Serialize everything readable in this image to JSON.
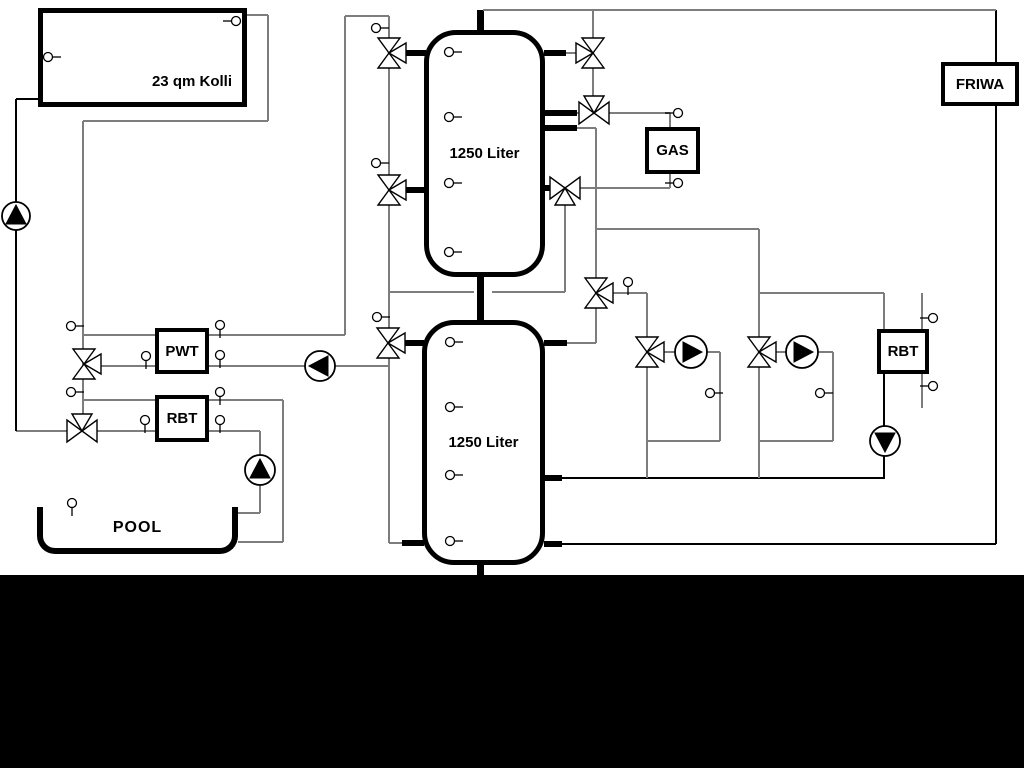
{
  "labels": {
    "collector": "23 qm Kolli",
    "tank_top": "1250 Liter",
    "tank_bottom": "1250 Liter",
    "pwt": "PWT",
    "rbt_left": "RBT",
    "rbt_right": "RBT",
    "gas": "GAS",
    "friwa": "FRIWA",
    "pool": "POOL"
  },
  "colors": {
    "line_gray": "#7d7d7d",
    "line_black": "#000000"
  },
  "diagram": {
    "band": {
      "top": 575,
      "height": 193
    },
    "lines": [
      [
        16,
        99,
        16,
        431,
        "b"
      ],
      [
        16,
        99,
        38,
        99,
        "b"
      ],
      [
        16,
        431,
        155,
        431,
        "g"
      ],
      [
        247,
        15,
        268,
        15,
        "g"
      ],
      [
        268,
        15,
        268,
        121,
        "g"
      ],
      [
        83,
        121,
        268,
        121,
        "g"
      ],
      [
        83,
        121,
        83,
        431,
        "g"
      ],
      [
        83,
        335,
        155,
        335,
        "g"
      ],
      [
        83,
        366,
        155,
        366,
        "g"
      ],
      [
        209,
        335,
        345,
        335,
        "g"
      ],
      [
        345,
        16,
        345,
        335,
        "g"
      ],
      [
        209,
        366,
        388,
        366,
        "g"
      ],
      [
        345,
        16,
        389,
        16,
        "g"
      ],
      [
        389,
        16,
        389,
        543,
        "g"
      ],
      [
        389,
        543,
        402,
        543,
        "g"
      ],
      [
        483,
        10,
        996,
        10,
        "g"
      ],
      [
        996,
        10,
        996,
        62,
        "b"
      ],
      [
        996,
        106,
        996,
        544,
        "b"
      ],
      [
        593,
        10,
        593,
        103,
        "g"
      ],
      [
        566,
        53,
        578,
        53,
        "g"
      ],
      [
        577,
        113,
        670,
        113,
        "g"
      ],
      [
        670,
        113,
        670,
        127,
        "g"
      ],
      [
        577,
        128,
        596,
        128,
        "g"
      ],
      [
        596,
        128,
        596,
        343,
        "g"
      ],
      [
        556,
        188,
        670,
        188,
        "g"
      ],
      [
        670,
        174,
        670,
        188,
        "g"
      ],
      [
        565,
        196,
        565,
        292,
        "g"
      ],
      [
        388,
        292,
        474,
        292,
        "g"
      ],
      [
        492,
        292,
        565,
        292,
        "g"
      ],
      [
        567,
        343,
        596,
        343,
        "g"
      ],
      [
        596,
        229,
        759,
        229,
        "g"
      ],
      [
        759,
        229,
        759,
        478,
        "g"
      ],
      [
        759,
        293,
        884,
        293,
        "g"
      ],
      [
        884,
        293,
        884,
        330,
        "g"
      ],
      [
        884,
        374,
        884,
        478,
        "b"
      ],
      [
        922,
        293,
        922,
        329,
        "g"
      ],
      [
        922,
        374,
        922,
        408,
        "g"
      ],
      [
        596,
        293,
        647,
        293,
        "g"
      ],
      [
        647,
        293,
        647,
        478,
        "g"
      ],
      [
        647,
        352,
        676,
        352,
        "g"
      ],
      [
        707,
        352,
        720,
        352,
        "g"
      ],
      [
        720,
        352,
        720,
        441,
        "g"
      ],
      [
        647,
        441,
        720,
        441,
        "g"
      ],
      [
        759,
        352,
        786,
        352,
        "g"
      ],
      [
        818,
        352,
        833,
        352,
        "g"
      ],
      [
        833,
        352,
        833,
        441,
        "g"
      ],
      [
        759,
        441,
        833,
        441,
        "g"
      ],
      [
        561,
        478,
        885,
        478,
        "b"
      ],
      [
        561,
        544,
        996,
        544,
        "b"
      ],
      [
        83,
        400,
        155,
        400,
        "g"
      ],
      [
        209,
        400,
        283,
        400,
        "g"
      ],
      [
        283,
        400,
        283,
        542,
        "g"
      ],
      [
        238,
        542,
        283,
        542,
        "g"
      ],
      [
        209,
        431,
        260,
        431,
        "g"
      ],
      [
        260,
        431,
        260,
        513,
        "g"
      ],
      [
        238,
        513,
        260,
        513,
        "g"
      ]
    ],
    "stubs": [
      [
        480,
        10,
        480,
        32
      ],
      [
        480,
        277,
        480,
        321
      ],
      [
        480,
        564,
        480,
        575
      ],
      [
        398,
        53,
        426,
        53
      ],
      [
        398,
        190,
        426,
        190
      ],
      [
        399,
        343,
        424,
        343
      ],
      [
        402,
        543,
        424,
        543
      ],
      [
        544,
        53,
        566,
        53
      ],
      [
        544,
        113,
        577,
        113
      ],
      [
        544,
        128,
        577,
        128
      ],
      [
        544,
        188,
        556,
        188
      ],
      [
        544,
        343,
        567,
        343
      ],
      [
        544,
        478,
        562,
        478
      ],
      [
        544,
        544,
        562,
        544
      ]
    ],
    "valves": [
      [
        84,
        364,
        "v",
        "r"
      ],
      [
        82,
        431,
        "h",
        "t"
      ],
      [
        389,
        53,
        "v",
        "r"
      ],
      [
        389,
        190,
        "v",
        "r"
      ],
      [
        388,
        343,
        "v",
        "r"
      ],
      [
        593,
        53,
        "v",
        "l"
      ],
      [
        594,
        113,
        "h",
        "t"
      ],
      [
        565,
        188,
        "h",
        "b"
      ],
      [
        596,
        293,
        "v",
        "r"
      ],
      [
        647,
        352,
        "v",
        "r"
      ],
      [
        759,
        352,
        "v",
        "r"
      ]
    ],
    "pumps": [
      [
        16,
        216,
        "up",
        14
      ],
      [
        320,
        366,
        "left",
        15
      ],
      [
        691,
        352,
        "right",
        16
      ],
      [
        802,
        352,
        "right",
        16
      ],
      [
        885,
        441,
        "down",
        15
      ],
      [
        260,
        470,
        "up",
        15
      ]
    ],
    "sensors": [
      [
        236,
        21,
        "l"
      ],
      [
        48,
        57,
        "r"
      ],
      [
        71,
        326,
        "r"
      ],
      [
        146,
        356,
        "d"
      ],
      [
        220,
        325,
        "d"
      ],
      [
        220,
        355,
        "d"
      ],
      [
        71,
        392,
        "r"
      ],
      [
        145,
        420,
        "d"
      ],
      [
        220,
        392,
        "d"
      ],
      [
        220,
        420,
        "d"
      ],
      [
        72,
        503,
        "d"
      ],
      [
        376,
        28,
        "r"
      ],
      [
        376,
        163,
        "r"
      ],
      [
        377,
        317,
        "r"
      ],
      [
        449,
        52,
        "r"
      ],
      [
        449,
        117,
        "r"
      ],
      [
        449,
        183,
        "r"
      ],
      [
        449,
        252,
        "r"
      ],
      [
        450,
        342,
        "r"
      ],
      [
        450,
        407,
        "r"
      ],
      [
        450,
        475,
        "r"
      ],
      [
        450,
        541,
        "r"
      ],
      [
        678,
        113,
        "l"
      ],
      [
        678,
        183,
        "l"
      ],
      [
        628,
        282,
        "d"
      ],
      [
        710,
        393,
        "r"
      ],
      [
        820,
        393,
        "r"
      ],
      [
        933,
        318,
        "l"
      ],
      [
        933,
        386,
        "l"
      ]
    ]
  }
}
